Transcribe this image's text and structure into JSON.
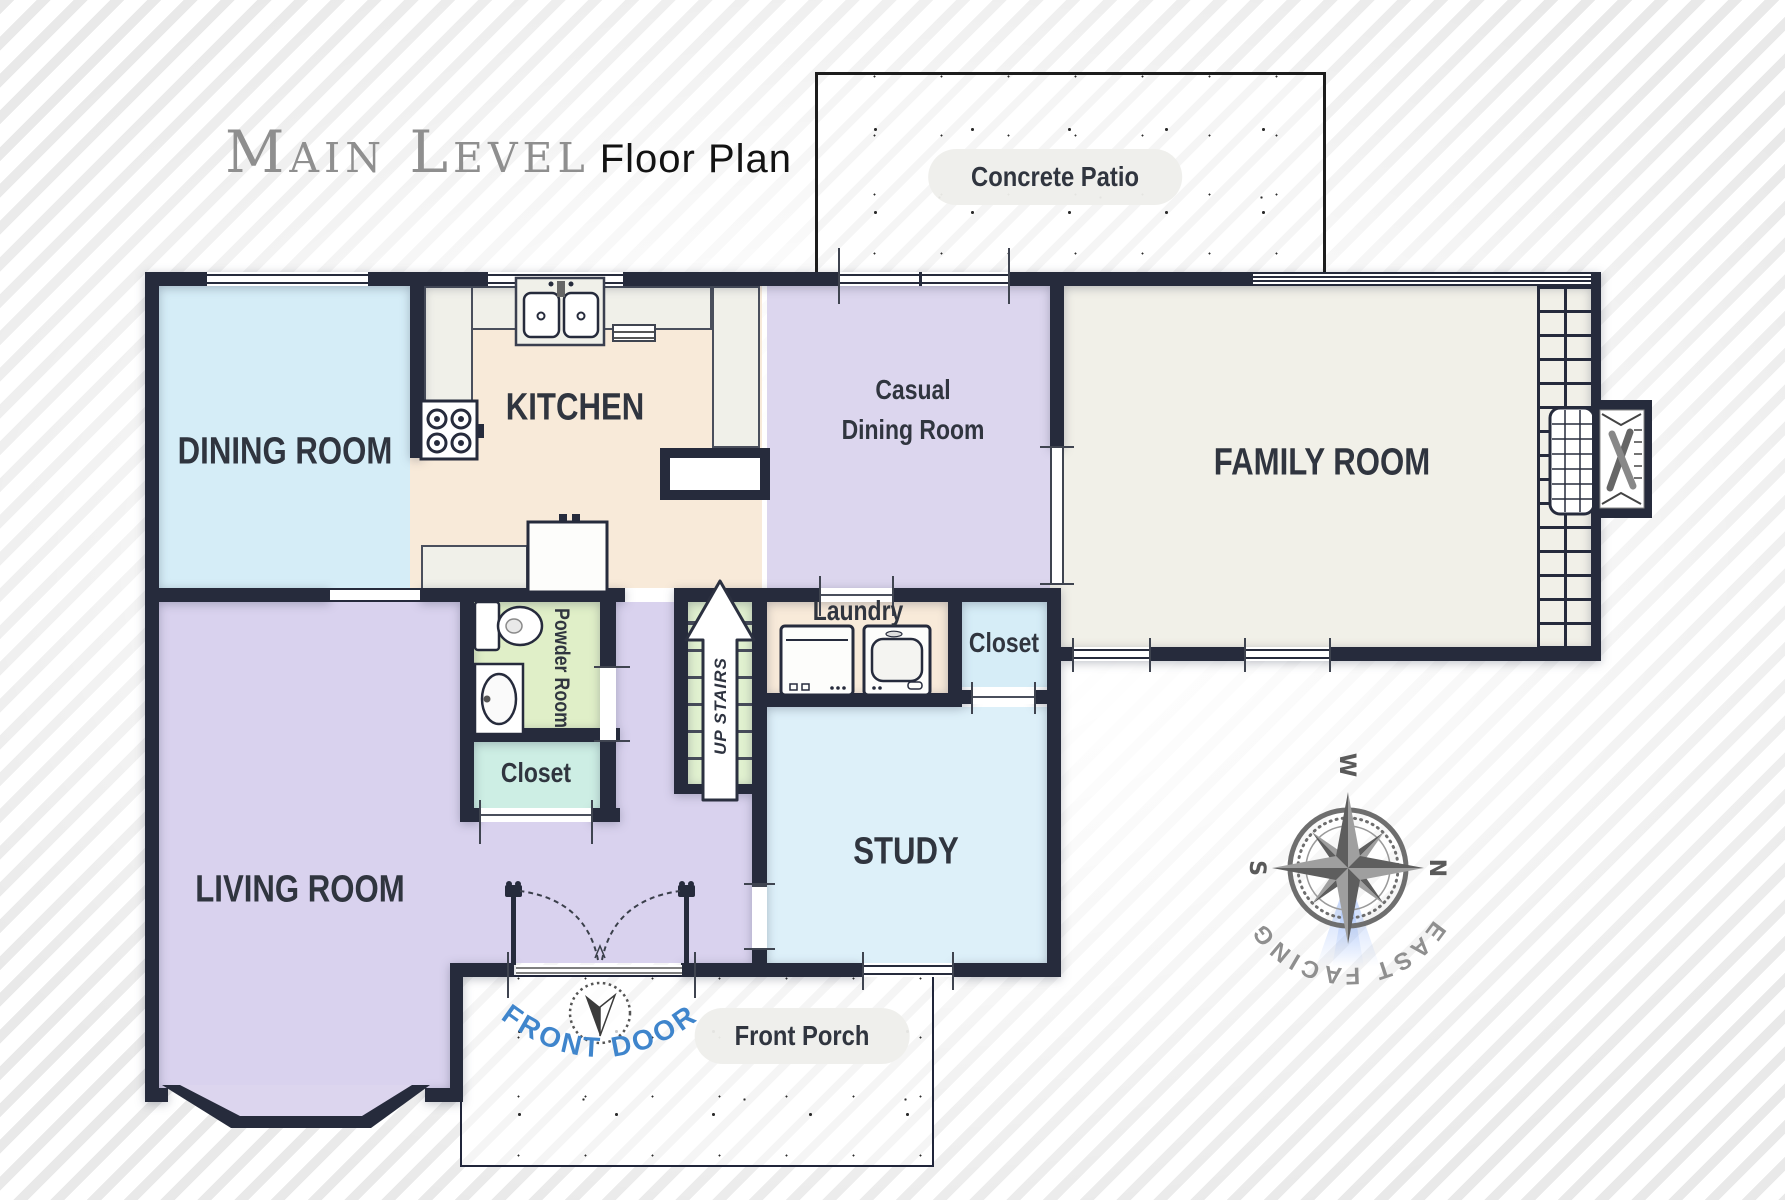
{
  "title": {
    "main": "Main Level",
    "sub": "Floor Plan"
  },
  "outdoor": {
    "patio": "Concrete Patio",
    "porch": "Front Porch",
    "front_door": "FRONT DOOR"
  },
  "rooms": {
    "dining": {
      "label": "DINING ROOM",
      "color": "#d5edf7"
    },
    "kitchen": {
      "label": "KITCHEN",
      "color": "#f8ead9"
    },
    "casual_dining": {
      "line1": "Casual",
      "line2": "Dining Room",
      "color": "#dcd6ee"
    },
    "family": {
      "label": "FAMILY ROOM",
      "color": "#f1f0e8"
    },
    "living": {
      "label": "LIVING ROOM",
      "color": "#d9d2ee"
    },
    "study": {
      "label": "STUDY",
      "color": "#ddf0f9"
    },
    "laundry": {
      "label": "Laundry",
      "color": "#f8ead9"
    },
    "closet_laundry": {
      "label": "Closet",
      "color": "#d6edf7"
    },
    "powder": {
      "label": "Powder Room",
      "color": "#e0efc8"
    },
    "closet_hall": {
      "label": "Closet",
      "color": "#cdeee4"
    },
    "stairs": {
      "label": "UP STAIRS",
      "color": "#e1f1d0"
    }
  },
  "compass": {
    "west": "W",
    "north": "N",
    "south": "S",
    "facing": "EAST FACING"
  },
  "colors": {
    "wall": "#262b3c",
    "front_door_text": "#3f85cc",
    "label_text": "#30353f"
  }
}
